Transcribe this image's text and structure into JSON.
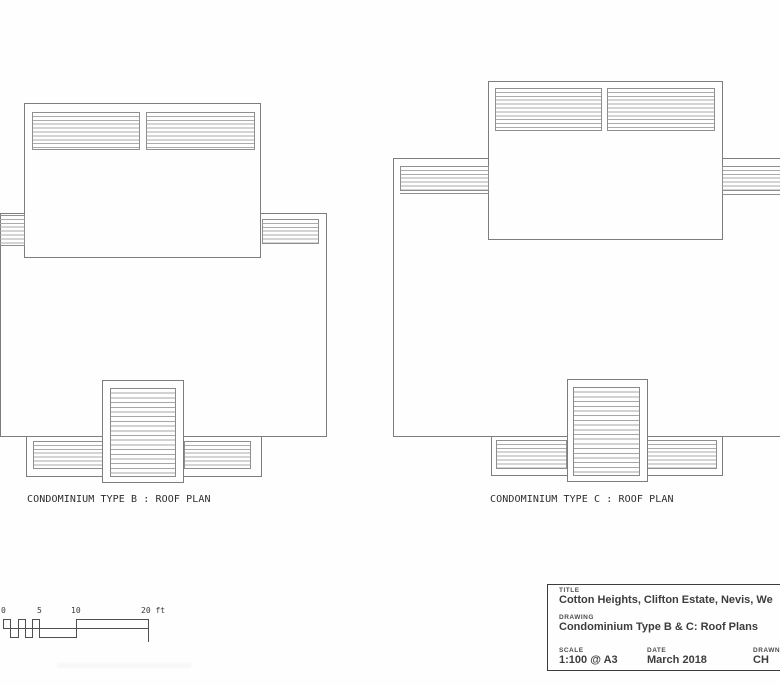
{
  "plans": [
    {
      "caption": "CONDOMINIUM TYPE B : ROOF PLAN"
    },
    {
      "caption": "CONDOMINIUM TYPE C : ROOF PLAN"
    }
  ],
  "scale_bar": {
    "ticks": [
      "0",
      "5",
      "10",
      "20 ft"
    ]
  },
  "title_block": {
    "title_label": "TITLE",
    "title_value": "Cotton Heights, Clifton Estate, Nevis, We",
    "drawing_label": "DRAWING",
    "drawing_value": "Condominium Type B & C: Roof Plans",
    "scale_label": "SCALE",
    "scale_value": "1:100 @ A3",
    "date_label": "DATE",
    "date_value": "March 2018",
    "drawn_label": "DRAWN",
    "drawn_value": "CH"
  },
  "colors": {
    "paper": "#fefefe",
    "plan_outline": "#7d7d7d",
    "hatch_line": "#ababab",
    "caption_text": "#2d2d2d",
    "title_block_ink": "#3b3b3b"
  }
}
